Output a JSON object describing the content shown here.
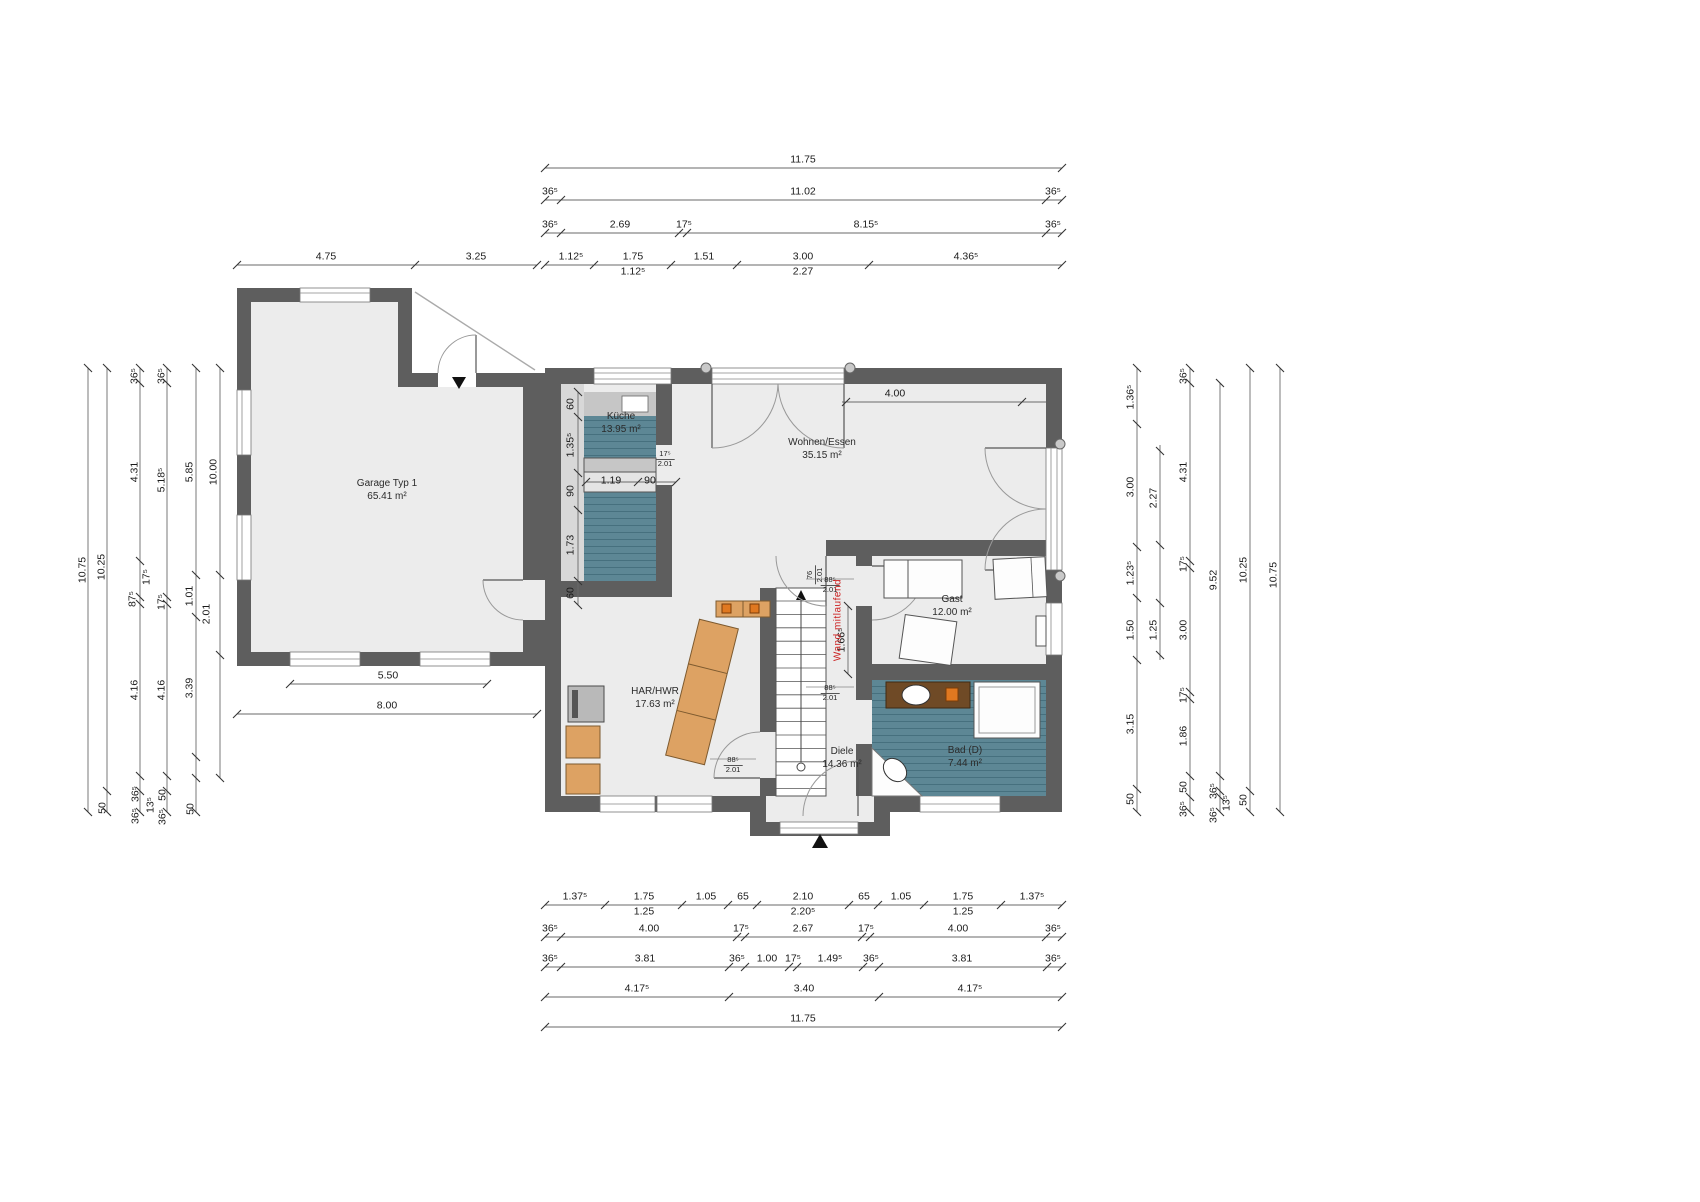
{
  "drawing": {
    "kind": "floor-plan",
    "floor": "ground floor"
  },
  "colors": {
    "wall": "#5e5e5e",
    "floor": "#ececec",
    "tile": "#5d8795",
    "wood": "#dda263",
    "annotation_red": "#cc2222",
    "counter": "#c6c6c6"
  },
  "rooms": [
    {
      "name": "Garage Typ 1",
      "area": "65.41 m²",
      "x": 387,
      "y": 490
    },
    {
      "name": "Küche",
      "area": "13.95 m²",
      "x": 621,
      "y": 423
    },
    {
      "name": "Wohnen/Essen",
      "area": "35.15 m²",
      "x": 822,
      "y": 449
    },
    {
      "name": "Gast",
      "area": "12.00 m²",
      "x": 952,
      "y": 606
    },
    {
      "name": "HAR/HWR",
      "area": "17.63 m²",
      "x": 655,
      "y": 698
    },
    {
      "name": "Diele",
      "area": "14.36 m²",
      "x": 842,
      "y": 758
    },
    {
      "name": "Bad (D)",
      "area": "7.44 m²",
      "x": 965,
      "y": 757
    }
  ],
  "wall_annotation": {
    "text": "Wand mitlaufend",
    "x": 838,
    "y": 620,
    "color": "#cc2222"
  },
  "door_labels": [
    {
      "top": "88⁵",
      "bottom": "2.01",
      "x": 830,
      "y": 585,
      "rot": false
    },
    {
      "top": "88⁵",
      "bottom": "2.01",
      "x": 830,
      "y": 693,
      "rot": false
    },
    {
      "top": "88⁵",
      "bottom": "2.01",
      "x": 733,
      "y": 765,
      "rot": false
    },
    {
      "top": "76",
      "bottom": "2.01",
      "x": 815,
      "y": 575,
      "rot": true
    },
    {
      "top": "17⁵",
      "bottom": "2.01",
      "x": 665,
      "y": 459,
      "rot": false
    }
  ],
  "dimension_labels": {
    "horizontal": [
      {
        "t": "11.75",
        "x": 803,
        "y": 160
      },
      {
        "t": "36⁵",
        "x": 550,
        "y": 192
      },
      {
        "t": "11.02",
        "x": 803,
        "y": 192
      },
      {
        "t": "36⁵",
        "x": 1053,
        "y": 192
      },
      {
        "t": "36⁵",
        "x": 550,
        "y": 225
      },
      {
        "t": "2.69",
        "x": 620,
        "y": 225
      },
      {
        "t": "17⁵",
        "x": 684,
        "y": 225
      },
      {
        "t": "8.15⁵",
        "x": 866,
        "y": 225
      },
      {
        "t": "36⁵",
        "x": 1053,
        "y": 225
      },
      {
        "t": "1.12⁵",
        "x": 571,
        "y": 257
      },
      {
        "t": "1.75",
        "x": 633,
        "y": 257
      },
      {
        "t": "1.51",
        "x": 704,
        "y": 257
      },
      {
        "t": "3.00",
        "x": 803,
        "y": 257
      },
      {
        "t": "4.36⁵",
        "x": 966,
        "y": 257
      },
      {
        "t": "1.12⁵",
        "x": 633,
        "y": 272
      },
      {
        "t": "2.27",
        "x": 803,
        "y": 272
      },
      {
        "t": "4.75",
        "x": 326,
        "y": 257
      },
      {
        "t": "3.25",
        "x": 476,
        "y": 257
      },
      {
        "t": "4.00",
        "x": 895,
        "y": 394
      },
      {
        "t": "5.50",
        "x": 388,
        "y": 676
      },
      {
        "t": "8.00",
        "x": 387,
        "y": 706
      },
      {
        "t": "1.19",
        "x": 611,
        "y": 481
      },
      {
        "t": "90",
        "x": 650,
        "y": 481
      },
      {
        "t": "1.37⁵",
        "x": 575,
        "y": 897
      },
      {
        "t": "1.75",
        "x": 644,
        "y": 897
      },
      {
        "t": "1.05",
        "x": 706,
        "y": 897
      },
      {
        "t": "65",
        "x": 743,
        "y": 897
      },
      {
        "t": "2.10",
        "x": 803,
        "y": 897
      },
      {
        "t": "65",
        "x": 864,
        "y": 897
      },
      {
        "t": "1.05",
        "x": 901,
        "y": 897
      },
      {
        "t": "1.75",
        "x": 963,
        "y": 897
      },
      {
        "t": "1.37⁵",
        "x": 1032,
        "y": 897
      },
      {
        "t": "1.25",
        "x": 644,
        "y": 912
      },
      {
        "t": "2.20⁵",
        "x": 803,
        "y": 912
      },
      {
        "t": "1.25",
        "x": 963,
        "y": 912
      },
      {
        "t": "36⁵",
        "x": 550,
        "y": 929
      },
      {
        "t": "4.00",
        "x": 649,
        "y": 929
      },
      {
        "t": "17⁵",
        "x": 741,
        "y": 929
      },
      {
        "t": "2.67",
        "x": 803,
        "y": 929
      },
      {
        "t": "17⁵",
        "x": 866,
        "y": 929
      },
      {
        "t": "4.00",
        "x": 958,
        "y": 929
      },
      {
        "t": "36⁵",
        "x": 1053,
        "y": 929
      },
      {
        "t": "36⁵",
        "x": 550,
        "y": 959
      },
      {
        "t": "3.81",
        "x": 645,
        "y": 959
      },
      {
        "t": "36⁵",
        "x": 737,
        "y": 959
      },
      {
        "t": "1.00",
        "x": 767,
        "y": 959
      },
      {
        "t": "17⁵",
        "x": 793,
        "y": 959
      },
      {
        "t": "1.49⁵",
        "x": 830,
        "y": 959
      },
      {
        "t": "36⁵",
        "x": 871,
        "y": 959
      },
      {
        "t": "3.81",
        "x": 962,
        "y": 959
      },
      {
        "t": "36⁵",
        "x": 1053,
        "y": 959
      },
      {
        "t": "4.17⁵",
        "x": 637,
        "y": 989
      },
      {
        "t": "3.40",
        "x": 804,
        "y": 989
      },
      {
        "t": "4.17⁵",
        "x": 970,
        "y": 989
      },
      {
        "t": "11.75",
        "x": 803,
        "y": 1019
      }
    ],
    "vertical": [
      {
        "t": "10.75",
        "x": 83,
        "y": 570
      },
      {
        "t": "10.25",
        "x": 102,
        "y": 567
      },
      {
        "t": "50",
        "x": 103,
        "y": 808
      },
      {
        "t": "36⁵",
        "x": 135,
        "y": 376
      },
      {
        "t": "4.31",
        "x": 135,
        "y": 472
      },
      {
        "t": "17⁵",
        "x": 147,
        "y": 577
      },
      {
        "t": "87⁵",
        "x": 133,
        "y": 599
      },
      {
        "t": "4.16",
        "x": 135,
        "y": 690
      },
      {
        "t": "36⁵",
        "x": 136,
        "y": 794
      },
      {
        "t": "36⁵",
        "x": 136,
        "y": 816
      },
      {
        "t": "13⁵",
        "x": 151,
        "y": 805
      },
      {
        "t": "36⁵",
        "x": 162,
        "y": 376
      },
      {
        "t": "5.18⁵",
        "x": 162,
        "y": 480
      },
      {
        "t": "17⁵",
        "x": 162,
        "y": 602
      },
      {
        "t": "4.16",
        "x": 162,
        "y": 690
      },
      {
        "t": "50",
        "x": 163,
        "y": 795
      },
      {
        "t": "36⁵",
        "x": 163,
        "y": 817
      },
      {
        "t": "5.85",
        "x": 190,
        "y": 472
      },
      {
        "t": "1.01",
        "x": 190,
        "y": 596
      },
      {
        "t": "3.39",
        "x": 190,
        "y": 688
      },
      {
        "t": "50",
        "x": 191,
        "y": 809
      },
      {
        "t": "10.00",
        "x": 214,
        "y": 472
      },
      {
        "t": "2.01",
        "x": 207,
        "y": 614
      },
      {
        "t": "60",
        "x": 571,
        "y": 404
      },
      {
        "t": "1.35⁵",
        "x": 571,
        "y": 445
      },
      {
        "t": "90",
        "x": 571,
        "y": 491
      },
      {
        "t": "1.73",
        "x": 571,
        "y": 545
      },
      {
        "t": "60",
        "x": 571,
        "y": 593
      },
      {
        "t": "1.66⁵",
        "x": 842,
        "y": 640
      },
      {
        "t": "1.36⁵",
        "x": 1131,
        "y": 397
      },
      {
        "t": "3.00",
        "x": 1131,
        "y": 487
      },
      {
        "t": "1.23⁵",
        "x": 1131,
        "y": 573
      },
      {
        "t": "1.50",
        "x": 1131,
        "y": 630
      },
      {
        "t": "3.15",
        "x": 1131,
        "y": 724
      },
      {
        "t": "50",
        "x": 1131,
        "y": 799
      },
      {
        "t": "2.27",
        "x": 1154,
        "y": 498
      },
      {
        "t": "1.25",
        "x": 1154,
        "y": 630
      },
      {
        "t": "36⁵",
        "x": 1184,
        "y": 376
      },
      {
        "t": "4.31",
        "x": 1184,
        "y": 472
      },
      {
        "t": "17⁵",
        "x": 1184,
        "y": 564
      },
      {
        "t": "3.00",
        "x": 1184,
        "y": 630
      },
      {
        "t": "17⁵",
        "x": 1184,
        "y": 695
      },
      {
        "t": "1.86",
        "x": 1184,
        "y": 736
      },
      {
        "t": "50",
        "x": 1184,
        "y": 787
      },
      {
        "t": "36⁵",
        "x": 1184,
        "y": 809
      },
      {
        "t": "9.52",
        "x": 1214,
        "y": 580
      },
      {
        "t": "36⁵",
        "x": 1214,
        "y": 791
      },
      {
        "t": "13⁵",
        "x": 1227,
        "y": 803
      },
      {
        "t": "36⁵",
        "x": 1214,
        "y": 815
      },
      {
        "t": "10.25",
        "x": 1244,
        "y": 570
      },
      {
        "t": "50",
        "x": 1244,
        "y": 800
      },
      {
        "t": "10.75",
        "x": 1274,
        "y": 575
      }
    ]
  }
}
